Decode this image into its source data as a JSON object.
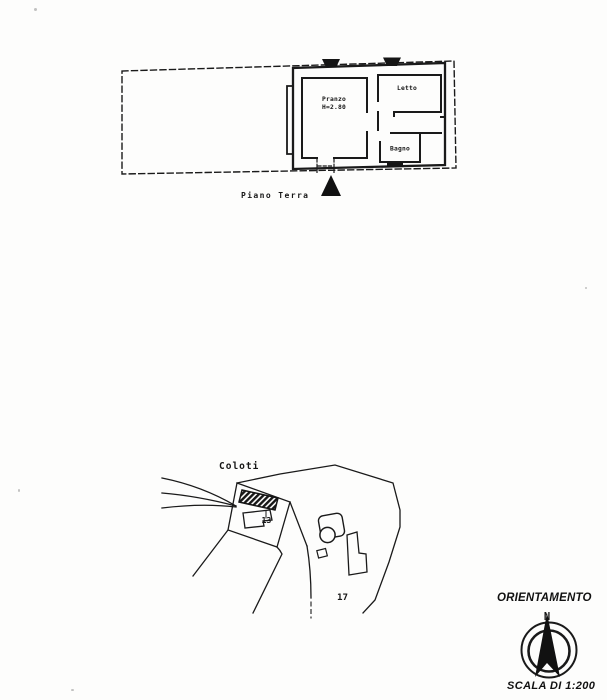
{
  "floor_plan": {
    "rooms": {
      "pranzo": {
        "label": "Pranzo",
        "height_note": "H=2.80"
      },
      "letto": {
        "label": "Letto"
      },
      "bagno": {
        "label": "Bagno"
      }
    },
    "caption": "Piano Terra"
  },
  "site_plan": {
    "locality_label": "Coloti",
    "parcel_13_label": "13",
    "parcel_17_label": "17"
  },
  "compass": {
    "title": "ORIENTAMENTO",
    "north_label": "N"
  },
  "scale_label": "SCALA DI 1:200",
  "colors": {
    "ink": "#1a1a1a",
    "paper": "#fdfdfc"
  }
}
